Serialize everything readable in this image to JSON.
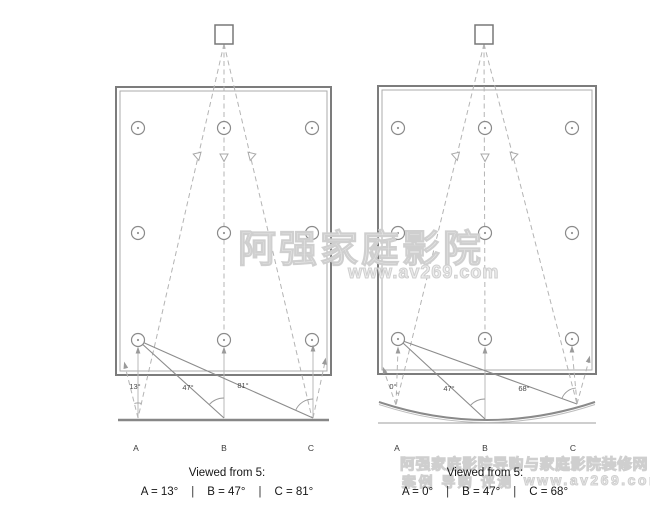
{
  "left": {
    "screen_type": "flat screen",
    "angle_a": "13°",
    "angle_b": "47°",
    "angle_c": "81°",
    "pos_a": "A",
    "pos_b": "B",
    "pos_c": "C",
    "caption": {
      "title": "Viewed from 5:",
      "a": "A = 13°",
      "b": "B = 47°",
      "c": "C = 81°",
      "sep": "|"
    }
  },
  "right": {
    "screen_type": "curved screen",
    "angle_a": "0°",
    "angle_b": "47°",
    "angle_c": "68°",
    "pos_a": "A",
    "pos_b": "B",
    "pos_c": "C",
    "caption": {
      "title": "Viewed from 5:",
      "a": "A = 0°",
      "b": "B = 47°",
      "c": "C = 68°",
      "sep": "|"
    }
  },
  "watermarks": {
    "center_main": "阿强家庭影院",
    "center_sub": "www.av269.com",
    "bottom_line1": "阿强家庭影院导购与家庭影院装修网",
    "bottom_line2_prefix": "案例 导购 评测",
    "bottom_line2_url": "www.av269.com"
  },
  "colors": {
    "line_gray": "#8c8c8c",
    "dash_gray": "#b4b4b4",
    "watermark_gray": "#cfcfcf",
    "text_dark": "#151515"
  }
}
